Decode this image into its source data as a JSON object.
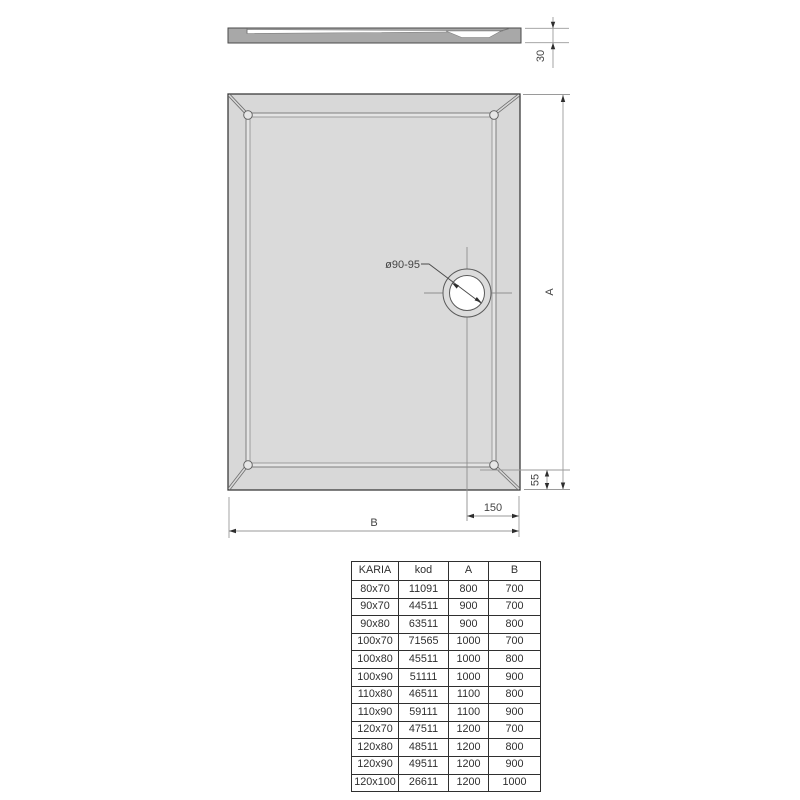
{
  "drawing": {
    "title": "shower-tray-dimension-drawing",
    "dims": {
      "height_30": "30",
      "a": "A",
      "b": "B",
      "offset_150": "150",
      "rim_55": "55",
      "drain": "ø90-95"
    },
    "colors": {
      "tray_fill": "#d8d8d8",
      "profile_fill": "#a8a8a8",
      "outline": "#3c3c3c",
      "dimension_line": "#9a9a9a",
      "text": "#444444"
    }
  },
  "table": {
    "headers": [
      "KARIA",
      "kod",
      "A",
      "B"
    ],
    "rows": [
      [
        "80x70",
        "11091",
        "800",
        "700"
      ],
      [
        "90x70",
        "44511",
        "900",
        "700"
      ],
      [
        "90x80",
        "63511",
        "900",
        "800"
      ],
      [
        "100x70",
        "71565",
        "1000",
        "700"
      ],
      [
        "100x80",
        "45511",
        "1000",
        "800"
      ],
      [
        "100x90",
        "51111",
        "1000",
        "900"
      ],
      [
        "110x80",
        "46511",
        "1100",
        "800"
      ],
      [
        "110x90",
        "59111",
        "1100",
        "900"
      ],
      [
        "120x70",
        "47511",
        "1200",
        "700"
      ],
      [
        "120x80",
        "48511",
        "1200",
        "800"
      ],
      [
        "120x90",
        "49511",
        "1200",
        "900"
      ],
      [
        "120x100",
        "26611",
        "1200",
        "1000"
      ]
    ]
  }
}
